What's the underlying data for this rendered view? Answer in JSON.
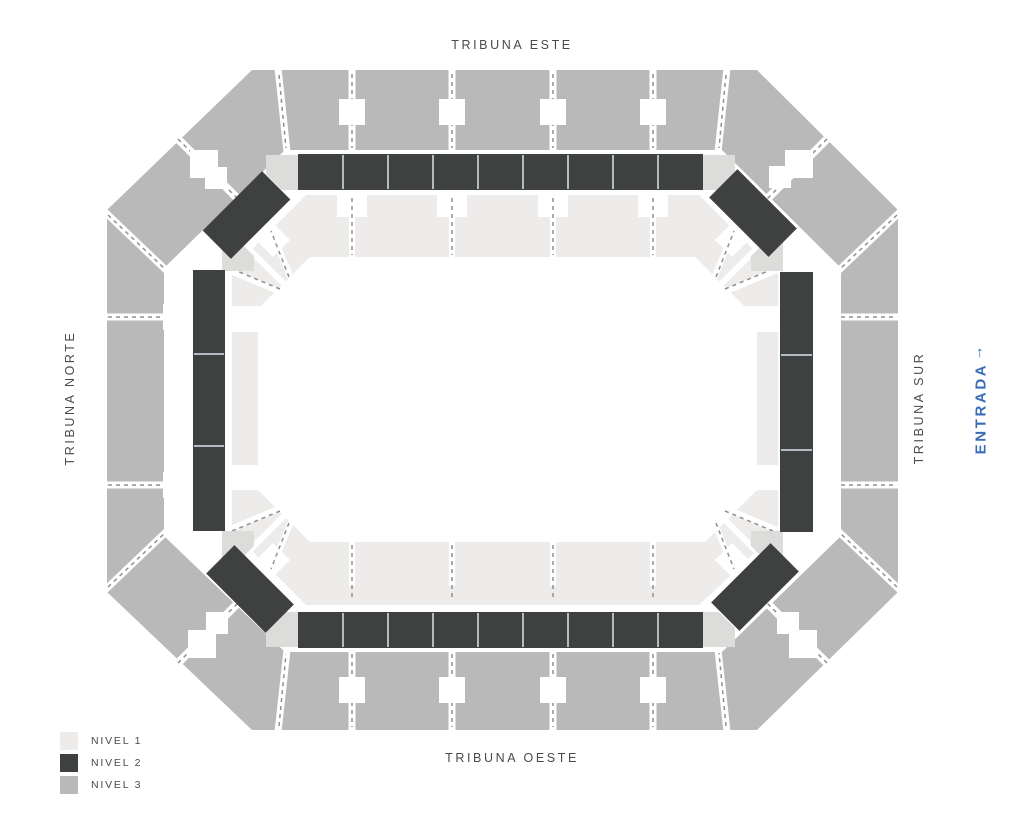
{
  "stands": {
    "top": "TRIBUNA ESTE",
    "bottom": "TRIBUNA OESTE",
    "left": "TRIBUNA NORTE",
    "right": "TRIBUNA SUR"
  },
  "entrance": {
    "label": "ENTRADA",
    "arrow": "↑"
  },
  "legend": {
    "items": [
      {
        "label": "NIVEL 1",
        "level": "level1"
      },
      {
        "label": "NIVEL 2",
        "level": "level2"
      },
      {
        "label": "NIVEL 3",
        "level": "level3"
      }
    ]
  },
  "colors": {
    "level1": "#edecea",
    "level2": "#3f4040",
    "level3": "#b9b9b9",
    "connector": "#dcdcda",
    "separator": "#b3bac2",
    "dash": "#8f8f8f",
    "text": "#4a4a4a",
    "accent": "#3a6cb8",
    "background": "#ffffff"
  }
}
